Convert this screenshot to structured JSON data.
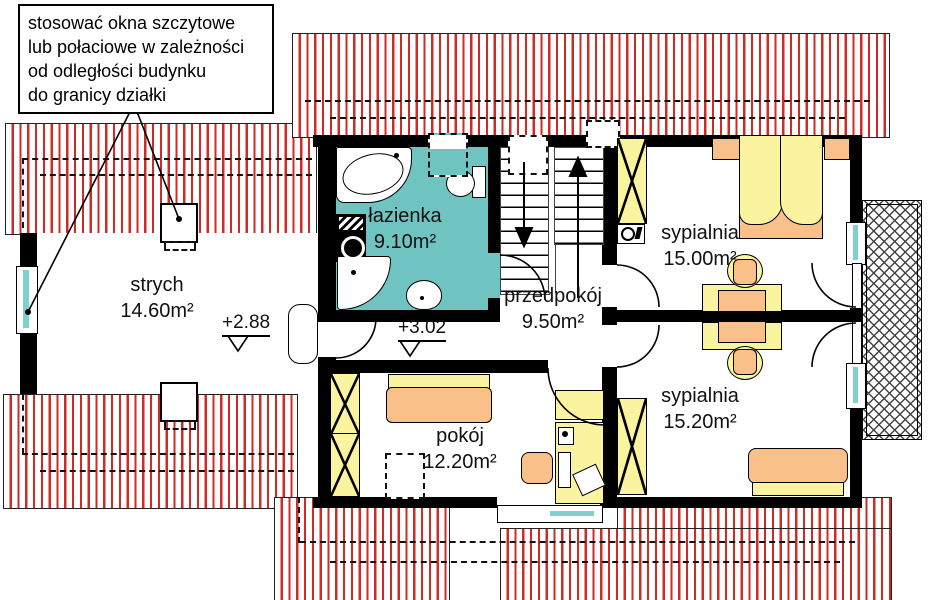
{
  "annotation_note": {
    "lines": [
      "stosować okna szczytowe",
      "lub połaciowe w zależności",
      "od odległości budynku",
      "do granicy działki"
    ]
  },
  "rooms": {
    "strych": {
      "name": "strych",
      "area": "14.60m²"
    },
    "lazienka": {
      "name": "łazienka",
      "area": "9.10m²"
    },
    "przedpokoj": {
      "name": "przedpokój",
      "area": "9.50m²"
    },
    "pokoj": {
      "name": "pokój",
      "area": "12.20m²"
    },
    "sypialnia1": {
      "name": "sypialnia",
      "area": "15.00m²"
    },
    "sypialnia2": {
      "name": "sypialnia",
      "area": "15.20m²"
    }
  },
  "levels": {
    "strych_level": "+2.88",
    "hall_level": "+3.02"
  },
  "colors": {
    "roof_hatch": "#cf2b24",
    "bathroom_floor": "#6fc3c1",
    "furniture_yellow": "#faf3a0",
    "furniture_orange": "#f9c189",
    "window_glass": "#7fd0cf",
    "wall": "#000000"
  }
}
